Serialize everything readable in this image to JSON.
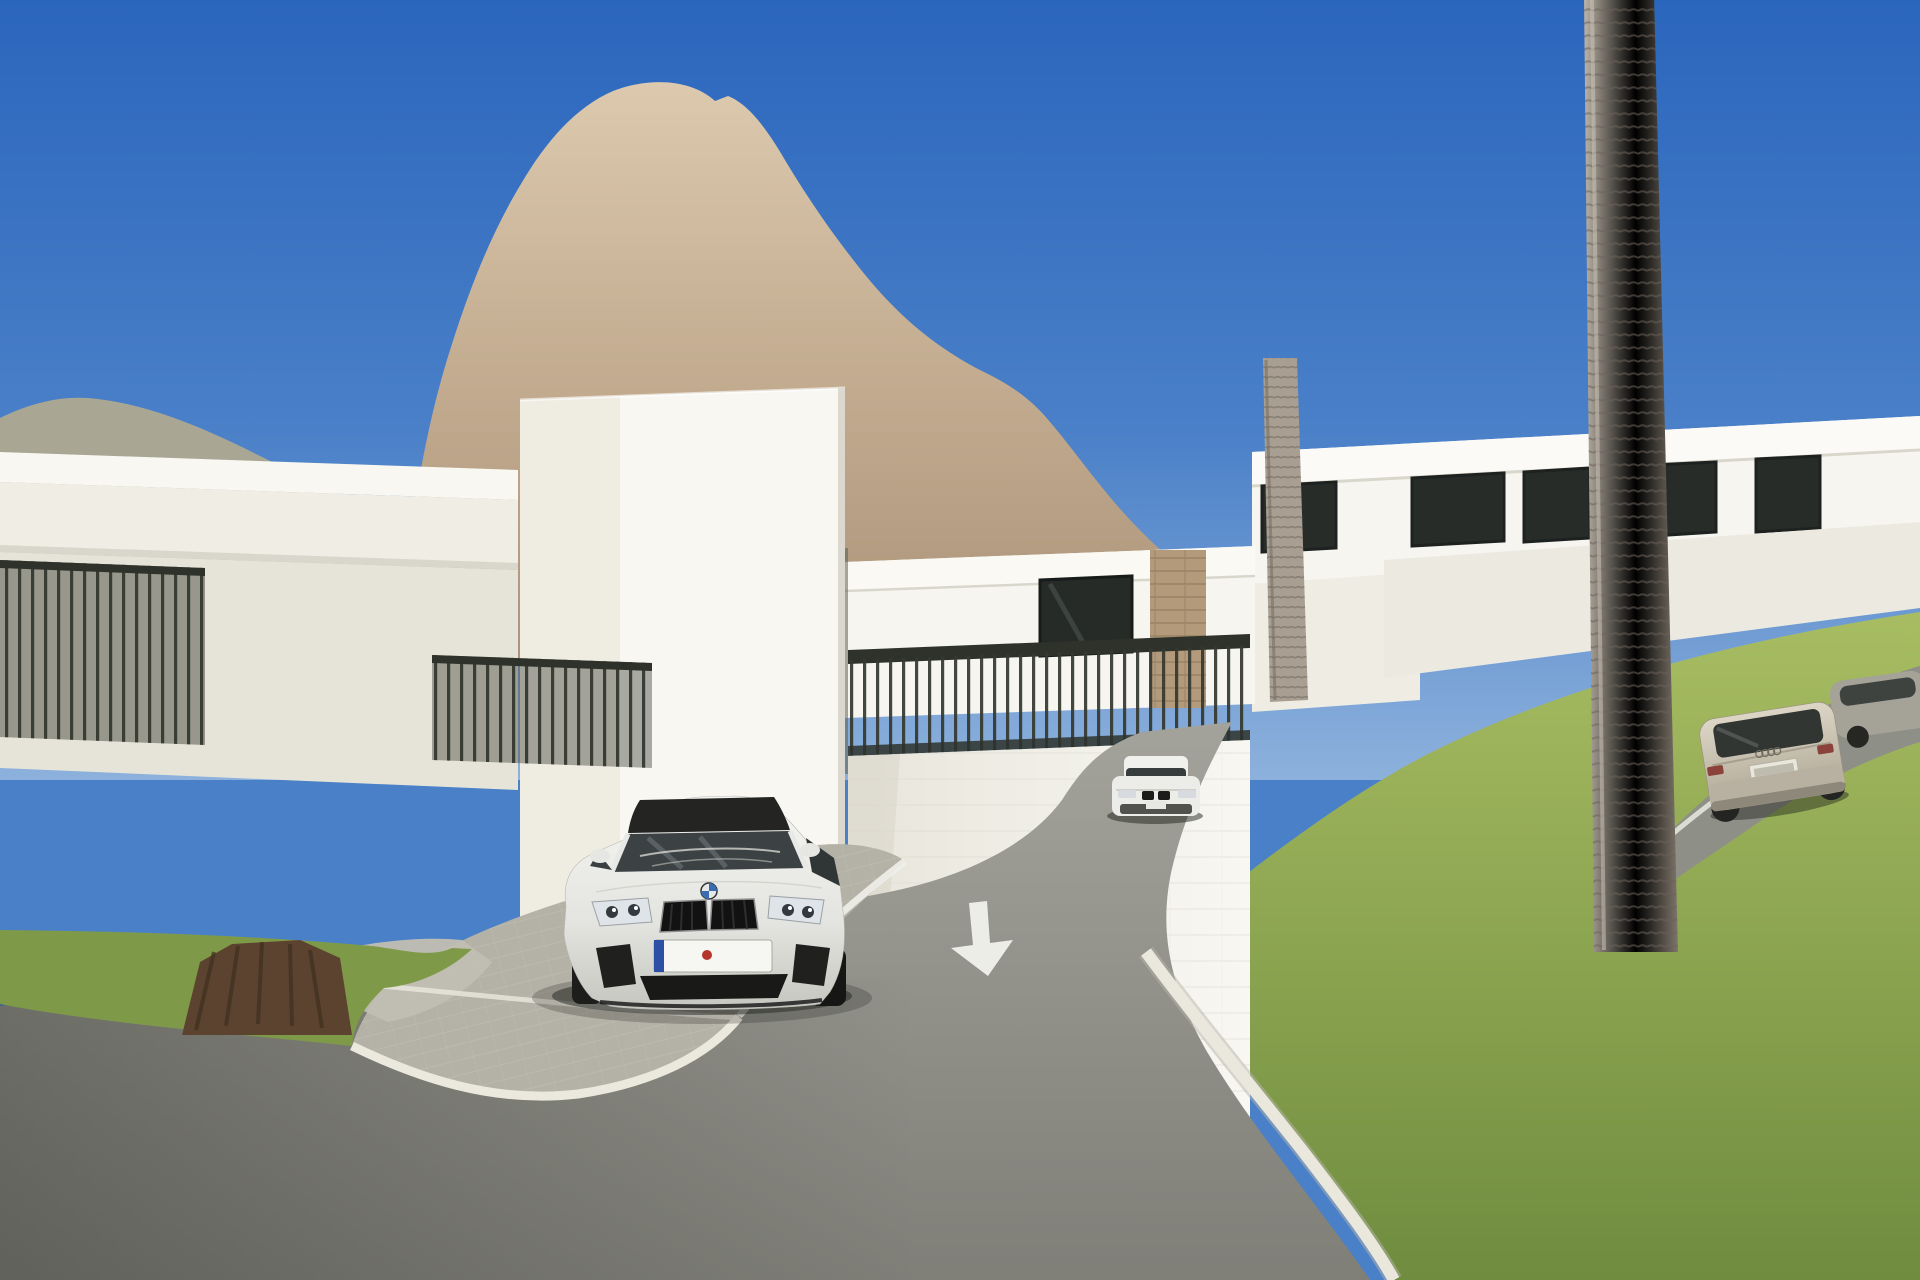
{
  "scene": {
    "type": "photorealistic exterior architectural rendering",
    "setting": "modern white flat-roof villas on a hillside below a large limestone rock peak, palm trees, flowering oleander bushes and a curving asphalt access road",
    "sky": "clear deep blue, sunny midday",
    "landmark": "large tan limestone crag with orange patches, smaller green rocky hill on the far left"
  },
  "palette": {
    "sky_top": "#2b66bd",
    "sky_mid": "#4a80c8",
    "sky_horizon": "#8db1dc",
    "rock_light": "#dcc9ae",
    "rock_base": "#c0a98e",
    "rock_orange": "#cd9166",
    "rock_gray": "#958c80",
    "rock_shadow": "#6e6558",
    "rock_highlight": "#e9dcc2",
    "hill_base": "#a9a794",
    "hill_green": "#4a5a33",
    "villa_white": "#f6f5f0",
    "villa_cream": "#efece2",
    "villa_shade": "#dedbd1",
    "villa_shadow": "#c7c4b9",
    "window_dark": "#272c29",
    "railing_dark": "#34382f",
    "stone_column": "#b29a7a",
    "vine_green": "#4c6a3a",
    "vine_dark": "#354e28",
    "palm_green": "#5c7b43",
    "palm_dark": "#415c2f",
    "palm_light": "#7fa055",
    "trunk_light": "#b0a89b",
    "trunk_dark": "#6f675c",
    "trunk_brown": "#5c432f",
    "grass_light": "#a2b75c",
    "grass_dark": "#6f8c3f",
    "road_light": "#a0a098",
    "road_dark": "#87877f",
    "paver": "#b4b1a6",
    "curb_white": "#eae8dd",
    "marking_white": "#eff0ea",
    "flower_white": "#f3f4ee",
    "flower_red": "#c2463e",
    "car_white": "#eeeeec",
    "car_champagne": "#cfc7b6",
    "car_gray": "#a5a298",
    "plate_bg": "#f6f6f2",
    "plate_band_blue": "#2b50a5",
    "plate_seal_red": "#b5342c",
    "plate_text": "#1b1b1b",
    "orange_fruit": "#e08a35"
  },
  "vehicles": {
    "bmw_foreground": {
      "description": "white coupe with dark roof parked on paver bay, front view",
      "plate": {
        "prefix": "RA",
        "suffix": "MN 202",
        "band": "EU blue band",
        "seal": "red inspection seal"
      }
    },
    "bmw_distant": {
      "description": "white sedan, front view, partly hidden behind white flowering bush"
    },
    "audi_wagon": {
      "description": "champagne estate car driving up the road, rear view, plate not readable"
    },
    "gray_car": {
      "description": "grey car ahead of the wagon, mostly hidden by flowers"
    }
  },
  "road": {
    "surface": "grey asphalt",
    "markings": {
      "arrow": "white arrow pointing down toward viewer",
      "edge_line": "white painted edge line"
    },
    "curb": "white concrete curb along right-hand lawn",
    "parking": "light grey block-paver parking bay"
  },
  "vegetation": {
    "palms": "tall ringed palm trunks right and centre, fan palm cluster left",
    "flowers": "white oleander masses with red clusters bottom right",
    "other": "slim cypresses by left villa, orange trees with fruit, ivy strands hanging over white walls, green leafy tree top right"
  }
}
